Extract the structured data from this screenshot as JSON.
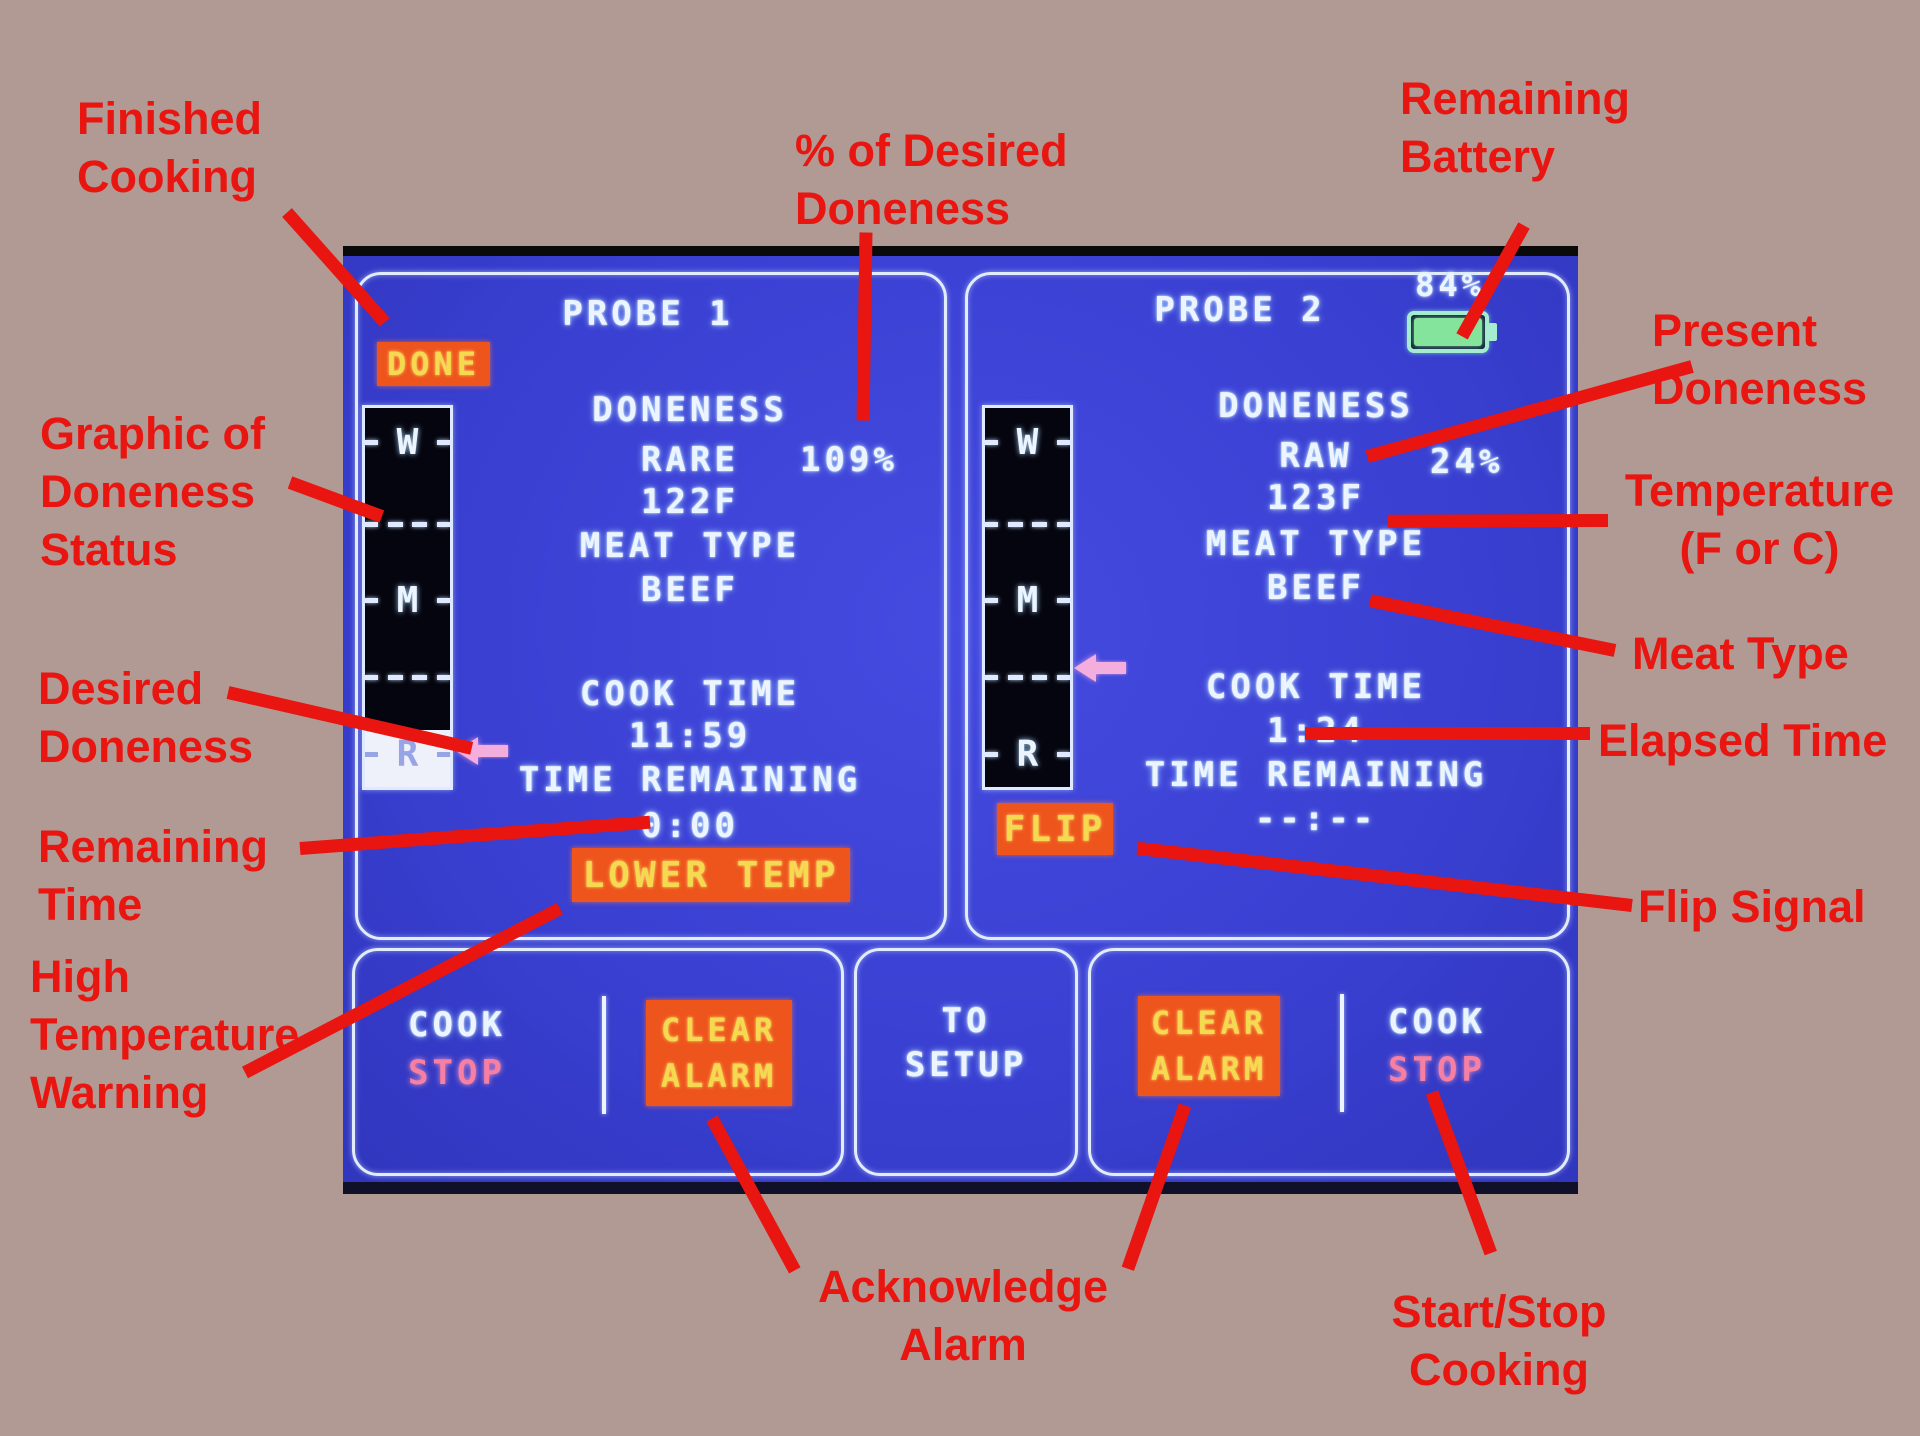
{
  "colors": {
    "background": "#b29a94",
    "annotation_red": "#e81510",
    "screen_blue": "#3a40d2",
    "badge_orange": "#ee551c",
    "badge_text_yellow": "#f5d94e",
    "screen_text": "#ecf5ff",
    "stop_pink": "#f67fa2",
    "battery_green": "#84e49c",
    "arrow_pink": "#f4aede"
  },
  "annotations": {
    "finished_cooking": {
      "line1": "Finished",
      "line2": "Cooking"
    },
    "pct_desired_doneness": {
      "line1": "% of Desired",
      "line2": "Doneness"
    },
    "remaining_battery": {
      "line1": "Remaining",
      "line2": "Battery"
    },
    "present_doneness": {
      "line1": "Present",
      "line2": "Doneness"
    },
    "temperature": {
      "line1": "Temperature",
      "line2": "(F or C)"
    },
    "meat_type": {
      "label": "Meat Type"
    },
    "elapsed_time": {
      "label": "Elapsed Time"
    },
    "flip_signal": {
      "label": "Flip Signal"
    },
    "graphic_doneness": {
      "line1": "Graphic of",
      "line2": "Doneness",
      "line3": "Status"
    },
    "desired_doneness": {
      "line1": "Desired",
      "line2": "Doneness"
    },
    "remaining_time": {
      "line1": "Remaining",
      "line2": "Time"
    },
    "high_temp_warning": {
      "line1": "High",
      "line2": "Temperature",
      "line3": "Warning"
    },
    "acknowledge_alarm": {
      "line1": "Acknowledge",
      "line2": "Alarm"
    },
    "start_stop_cooking": {
      "line1": "Start/Stop",
      "line2": "Cooking"
    }
  },
  "screen": {
    "scale": {
      "w": "W",
      "m": "M",
      "r": "R"
    },
    "probe1": {
      "title": "PROBE 1",
      "done_badge": "DONE",
      "doneness_label": "DONENESS",
      "doneness_value": "RARE",
      "doneness_pct": "109%",
      "temperature": "122F",
      "meat_type_label": "MEAT TYPE",
      "meat_type_value": "BEEF",
      "cook_time_label": "COOK TIME",
      "cook_time_value": "11:59",
      "time_remaining_label": "TIME REMAINING",
      "time_remaining_value": "0:00",
      "warning_badge": "LOWER TEMP"
    },
    "probe2": {
      "title": "PROBE 2",
      "battery_pct": "84%",
      "doneness_label": "DONENESS",
      "doneness_value": "RAW",
      "doneness_pct": "24%",
      "temperature": "123F",
      "meat_type_label": "MEAT TYPE",
      "meat_type_value": "BEEF",
      "cook_time_label": "COOK TIME",
      "cook_time_value": "1:24",
      "time_remaining_label": "TIME REMAINING",
      "time_remaining_value": "--:--",
      "flip_badge": "FLIP"
    },
    "controls": {
      "left_cook": "COOK",
      "left_stop": "STOP",
      "left_clear_line1": "CLEAR",
      "left_clear_line2": "ALARM",
      "setup_line1": "TO",
      "setup_line2": "SETUP",
      "right_clear_line1": "CLEAR",
      "right_clear_line2": "ALARM",
      "right_cook": "COOK",
      "right_stop": "STOP"
    }
  }
}
